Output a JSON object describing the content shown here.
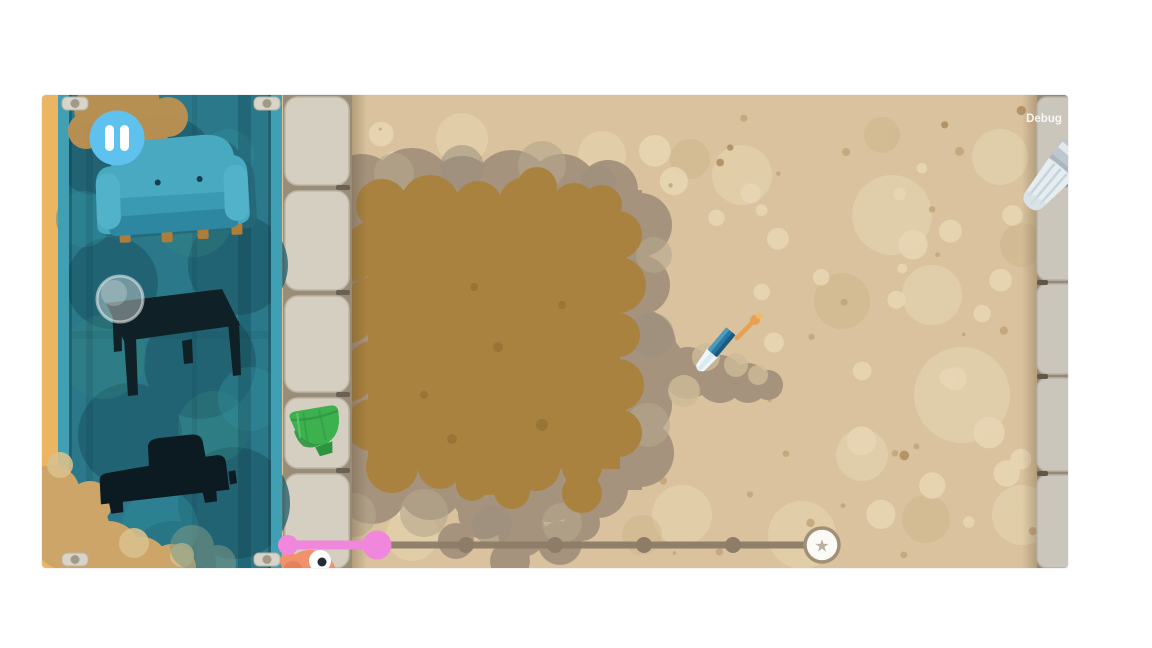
{
  "hud": {
    "debug_label": "Debug"
  },
  "pause_button": {
    "icon": "pause-icon"
  },
  "blueprint": {
    "items": [
      {
        "id": "couch",
        "status": "colored"
      },
      {
        "id": "table",
        "status": "silhouette",
        "marker": "lens-circle"
      },
      {
        "id": "bed",
        "status": "silhouette"
      }
    ]
  },
  "field": {
    "collectible": "green-bowl",
    "tool": "dig-brush-icon",
    "artifact": "buried-orange-stick"
  },
  "progress": {
    "segments": 6,
    "completed": 1,
    "goal_icon": "★"
  },
  "colors": {
    "accent_pink": "#f186dd",
    "path_gray": "#8d7d68",
    "sand_base": "#d9c29d",
    "sand_light": "#e7d5b2",
    "sand_speck": "#c2a379",
    "hole_inner": "#a9823f",
    "hole_ring": "#a6937d",
    "panel_teal": "#2a7889",
    "pause_blue": "#5fc2ee",
    "bowl_green": "#3cb14e",
    "creature_orange": "#f0926b",
    "brush_blue": "#2b7fc2",
    "strip_yellow": "#ecb561"
  }
}
